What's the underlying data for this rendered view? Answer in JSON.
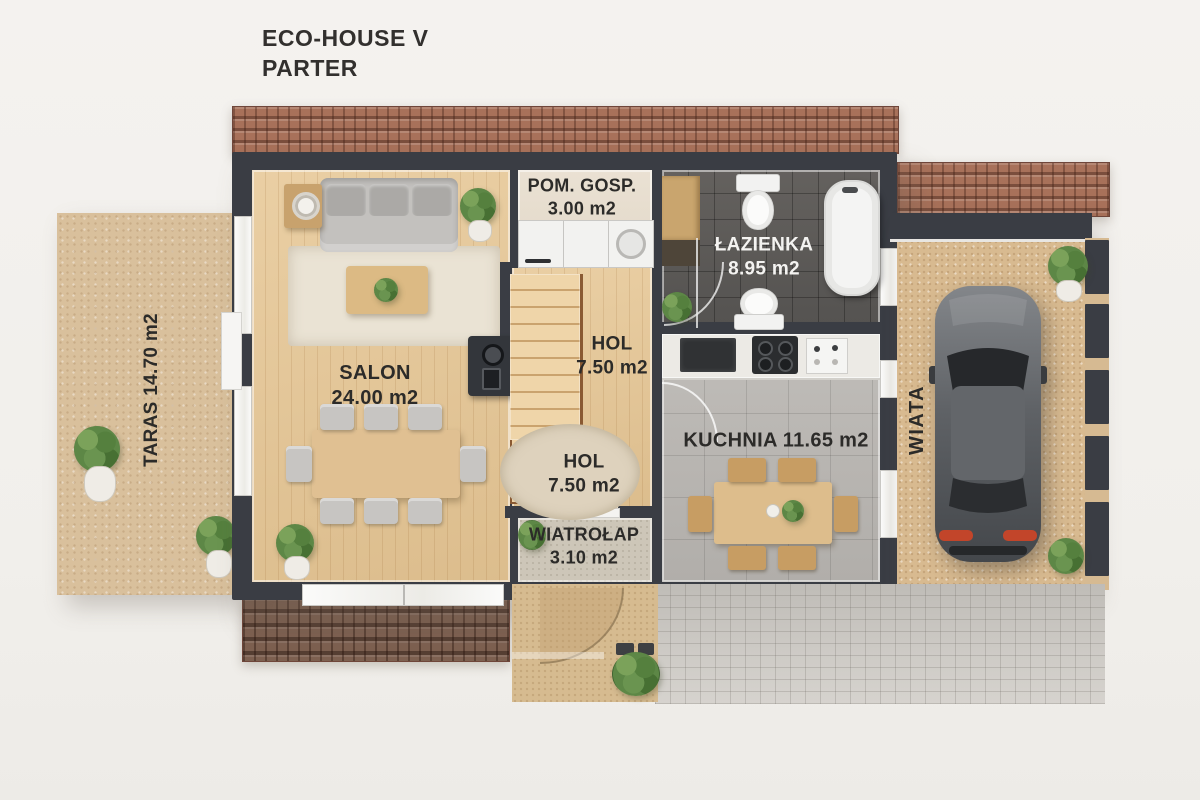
{
  "title": {
    "project": "ECO-HOUSE V",
    "floor": "PARTER"
  },
  "rooms": {
    "taras": {
      "label": "TARAS 14.70 m2"
    },
    "salon": {
      "name": "SALON",
      "area": "24.00 m2"
    },
    "pom_gosp": {
      "name": "POM. GOSP.",
      "area": "3.00 m2"
    },
    "lazienka": {
      "name": "ŁAZIENKA",
      "area": "8.95 m2"
    },
    "hol_gora": {
      "name": "HOL",
      "area": "7.50 m2"
    },
    "hol_dol": {
      "name": "HOL",
      "area": "7.50 m2"
    },
    "kuchnia": {
      "label": "KUCHNIA 11.65 m2"
    },
    "wiatrolap": {
      "name": "WIATROŁAP",
      "area": "3.10 m2"
    },
    "wiata": {
      "label": "WIATA"
    }
  },
  "colors": {
    "background": "#f3f1ee",
    "wall": "#3a3d44",
    "roof": "#a8715a",
    "roof_dark": "#7d6050",
    "wood_floor": "#e2c69c",
    "terrace_sand": "#d9c09c",
    "bathroom_tile": "#5b5a58",
    "kitchen_tile": "#b5b4b0",
    "carport_gravel": "#d8ba90",
    "driveway_cobble": "#c9c6c1",
    "label_dark": "#2c2b29",
    "label_light": "#f4f3f1",
    "taillight": "#c2452a"
  }
}
